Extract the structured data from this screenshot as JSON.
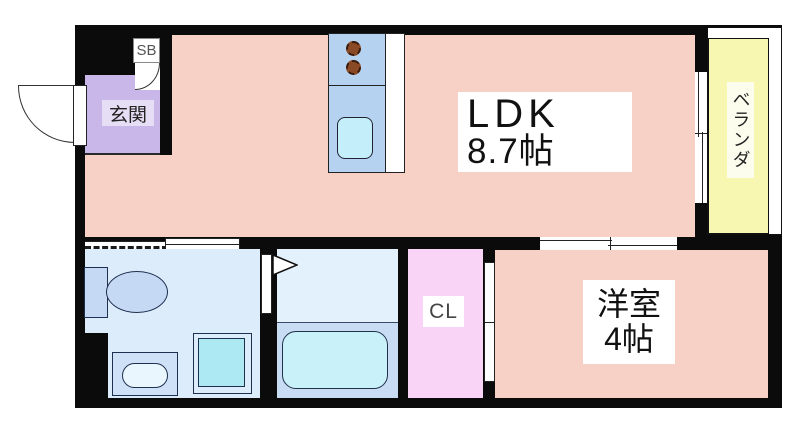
{
  "rooms": {
    "ldk": {
      "label": "LDK",
      "size": "8.7帖"
    },
    "genkan": {
      "label": "玄関"
    },
    "shoe_box": {
      "label": "SB"
    },
    "veranda": {
      "label": "ベランダ"
    },
    "closet": {
      "label": "CL"
    },
    "western_room": {
      "label": "洋室",
      "size": "4帖"
    }
  },
  "colors": {
    "wall": "#0b0b0b",
    "room_pink": "#f7d1c6",
    "genkan_lavender": "#c8b7e8",
    "closet_pink": "#f9d4f6",
    "veranda_yellow": "#f7f7b2",
    "kitchen_counter_blue": "#b5d3f0",
    "washroom_blue": "#dcecfa",
    "bathroom_lower_blue": "#c8dcf4",
    "fixture_fill": "#c6d9f4",
    "tub_cyan": "#c9f1fa",
    "sink_cyan": "#c4eefa",
    "burner_brown": "#8b4a26"
  }
}
